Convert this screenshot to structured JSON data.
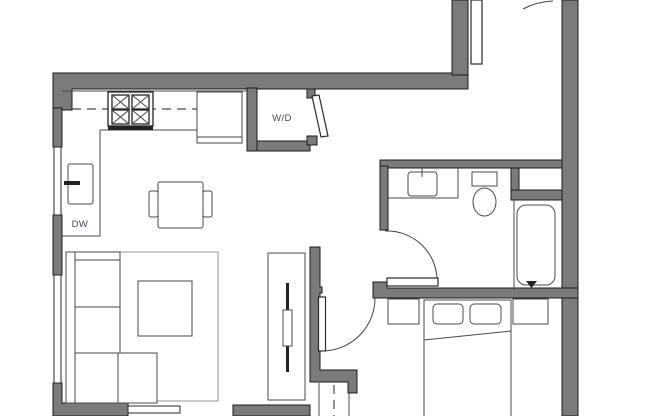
{
  "colors": {
    "background": "#ffffff",
    "wall_fill": "#7b7b7b",
    "wall_outline": "#1b1b1b",
    "fixture_line": "#4a4a4a",
    "rug_line": "#949494",
    "label_text": "#3d4a58"
  },
  "labels": {
    "washer_dryer": "W/D",
    "dishwasher": "DW"
  }
}
